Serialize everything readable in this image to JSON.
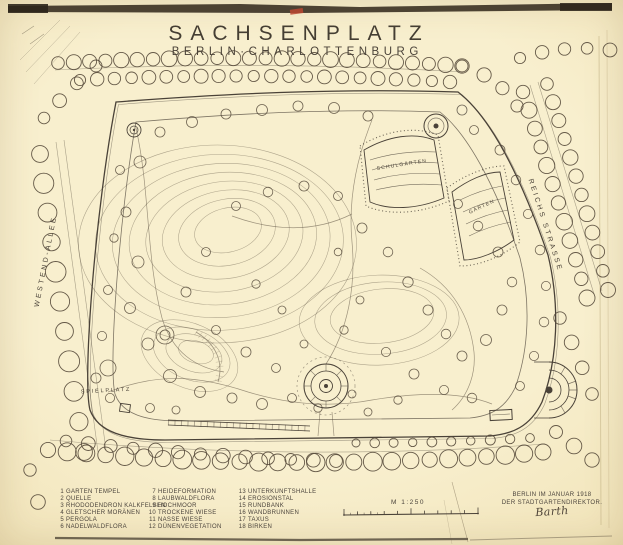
{
  "document": {
    "title": "SACHSENPLATZ",
    "subtitle": "BERLIN·CHARLOTTENBURG"
  },
  "streets": {
    "left": "WESTEND-ALLEE",
    "right": "REICHS STRASSE"
  },
  "plan_labels": {
    "playground": "SPIELPLATZ",
    "school_gardens": "SCHULGÄRTEN",
    "gardens": "GÄRTEN"
  },
  "legend": {
    "columns": [
      {
        "items": [
          {
            "num": "1",
            "label": "GARTEN TEMPEL"
          },
          {
            "num": "2",
            "label": "QUELLE"
          },
          {
            "num": "3",
            "label": "RHODODENDRON KALKFELSEN"
          },
          {
            "num": "4",
            "label": "GLETSCHER MORÄNEN"
          },
          {
            "num": "5",
            "label": "PERGOLA"
          },
          {
            "num": "6",
            "label": "NADELWALDFLORA"
          }
        ]
      },
      {
        "items": [
          {
            "num": "7",
            "label": "HEIDEFORMATION"
          },
          {
            "num": "8",
            "label": "LAUBWALDFLORA"
          },
          {
            "num": "9",
            "label": "HOCHMOOR"
          },
          {
            "num": "10",
            "label": "TROCKENE WIESE"
          },
          {
            "num": "11",
            "label": "NASSE WIESE"
          },
          {
            "num": "12",
            "label": "DÜNENVEGETATION"
          }
        ]
      },
      {
        "items": [
          {
            "num": "13",
            "label": "UNTERKUNFTSHALLE"
          },
          {
            "num": "14",
            "label": "EROSIONSTAL"
          },
          {
            "num": "15",
            "label": "RUNDBANK"
          },
          {
            "num": "16",
            "label": "WANDBRUNNEN"
          },
          {
            "num": "17",
            "label": "TAXUS"
          },
          {
            "num": "18",
            "label": "BIRKEN"
          }
        ]
      }
    ]
  },
  "scale": {
    "label": "M 1:250"
  },
  "imprint": {
    "place_date": "BERLIN IM JANUAR 1918",
    "author": "DER STADTGARTENDIREKTOR.",
    "signature": "Barth"
  },
  "colors": {
    "paper": "#f6ecca",
    "ink": "#4a4238",
    "red_mark": "#bb4630"
  }
}
